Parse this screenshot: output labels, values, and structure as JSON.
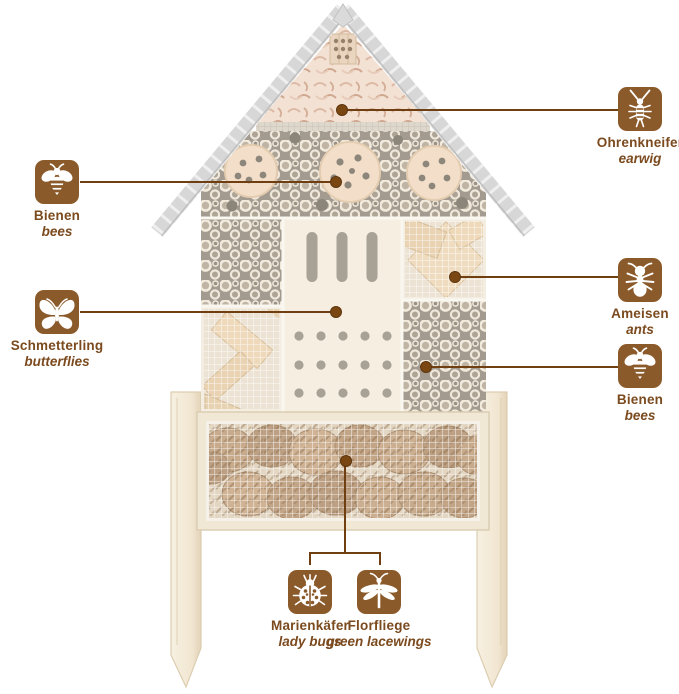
{
  "colors": {
    "accent_brown": "#8b5a2a",
    "label_text_brown": "#7b4a1e",
    "callout_line_brown": "#6f3f12",
    "roof_gray": "#d7d7d7",
    "wood_light": "#f2e9d8"
  },
  "callouts": [
    {
      "id": "ohrenkneifer",
      "de": "Ohrenkneifer",
      "en": "earwig",
      "icon": "earwig-icon"
    },
    {
      "id": "bienen-left",
      "de": "Bienen",
      "en": "bees",
      "icon": "bee-icon"
    },
    {
      "id": "schmetterling",
      "de": "Schmetterling",
      "en": "butterflies",
      "icon": "butterfly-icon"
    },
    {
      "id": "ameisen",
      "de": "Ameisen",
      "en": "ants",
      "icon": "ant-icon"
    },
    {
      "id": "bienen-right",
      "de": "Bienen",
      "en": "bees",
      "icon": "bee-icon"
    },
    {
      "id": "marienkaefer",
      "de": "Marienkäfer",
      "en": "lady bugs",
      "icon": "ladybug-icon"
    },
    {
      "id": "florfliege",
      "de": "Florfliege",
      "en": "green lacewings",
      "icon": "lacewing-icon"
    }
  ]
}
